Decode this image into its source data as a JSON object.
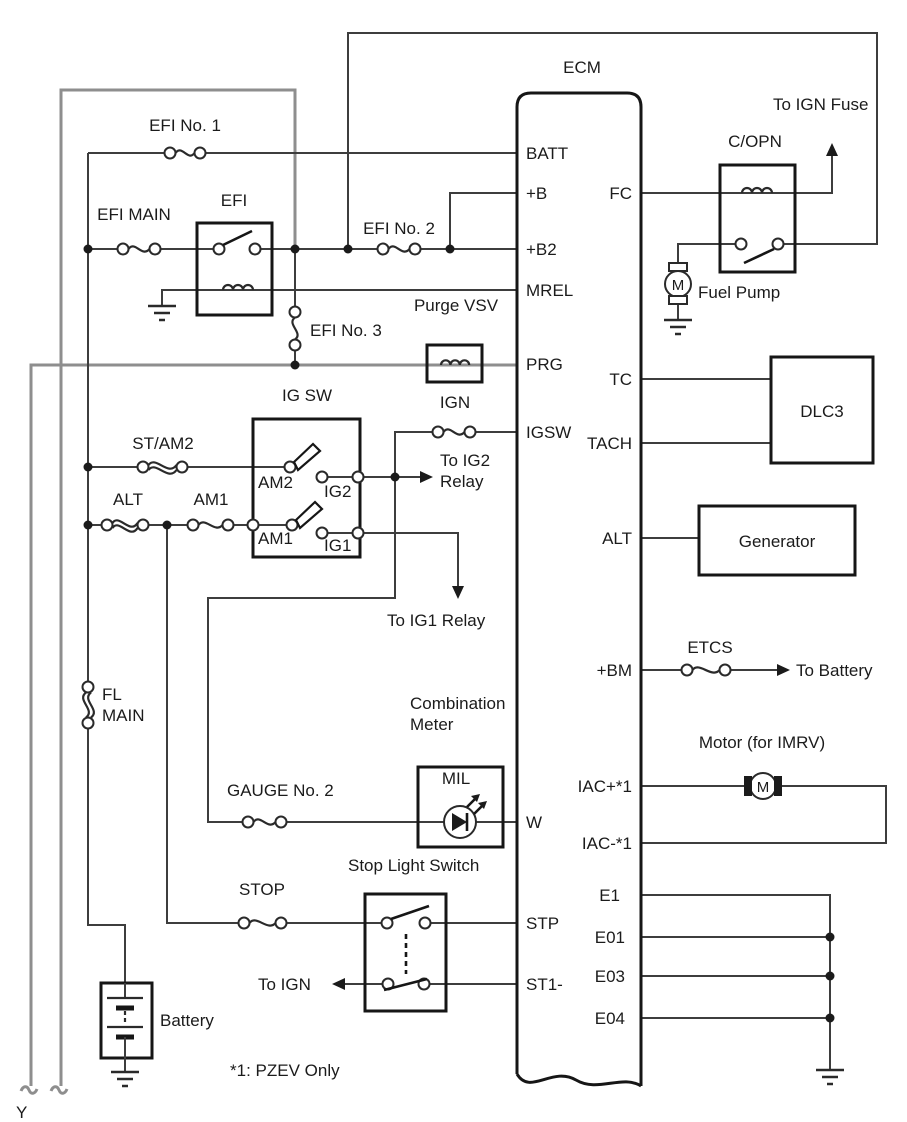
{
  "colors": {
    "background": "#ffffff",
    "wire": "#3d3d3d",
    "gray_wire": "#8e8e8e",
    "component_outline": "#161616",
    "text": "#1b1b1b"
  },
  "ecm": {
    "label": "ECM",
    "left_pins": [
      "BATT",
      "+B",
      "+B2",
      "MREL",
      "PRG",
      "IGSW",
      "W",
      "STP",
      "ST1-"
    ],
    "right_pins": [
      "FC",
      "TC",
      "TACH",
      "ALT",
      "+BM",
      "IAC+*1",
      "IAC-*1",
      "E1",
      "E01",
      "E03",
      "E04"
    ]
  },
  "fuses": {
    "efi_no1": "EFI No. 1",
    "efi_main": "EFI MAIN",
    "efi_no2": "EFI No. 2",
    "efi_no3": "EFI No. 3",
    "ign": "IGN",
    "st_am2": "ST/AM2",
    "alt": "ALT",
    "am1": "AM1",
    "fl_main": [
      "FL",
      "MAIN"
    ],
    "gauge_no2": "GAUGE No. 2",
    "stop": "STOP",
    "etcs": "ETCS"
  },
  "components": {
    "efi_relay": "EFI",
    "purge_vsv": "Purge VSV",
    "ig_sw": "IG SW",
    "copn": "C/OPN",
    "fuel_pump": "Fuel Pump",
    "dlc3": "DLC3",
    "generator": "Generator",
    "motor_imrv": "Motor (for IMRV)",
    "combination_meter": [
      "Combination",
      "Meter"
    ],
    "mil": "MIL",
    "stop_light_switch": "Stop Light Switch",
    "battery": "Battery",
    "motor_letter": "M"
  },
  "ig_sw_terminals": {
    "am2": "AM2",
    "am1": "AM1",
    "ig2": "IG2",
    "ig1": "IG1"
  },
  "annotations": {
    "to_ign_fuse": "To IGN Fuse",
    "to_ig2_relay": [
      "To IG2",
      "Relay"
    ],
    "to_ig1_relay": "To IG1 Relay",
    "to_battery": "To Battery",
    "to_ign": "To IGN",
    "pzev_note": "*1: PZEV Only",
    "page_connector": "Y"
  }
}
